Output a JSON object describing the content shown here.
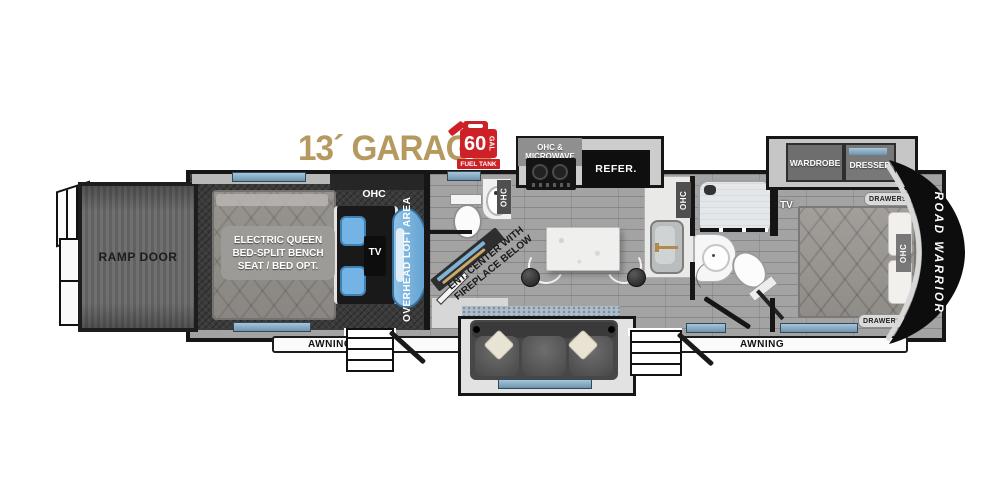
{
  "header": {
    "garage_title": "13´ GARAGE",
    "fuel_tank": {
      "value": "60",
      "unit": "GAL",
      "caption": "FUEL TANK"
    }
  },
  "exterior": {
    "ramp_door_label": "RAMP DOOR",
    "awning_left_label": "AWNING",
    "awning_right_label": "AWNING",
    "brand_label": "ROAD WARRIOR"
  },
  "garage": {
    "ohc_label": "OHC",
    "bed_label_line1": "ELECTRIC QUEEN",
    "bed_label_line2": "BED-SPLIT BENCH",
    "bed_label_line3": "SEAT / BED OPT.",
    "tv_label": "TV",
    "loft_label": "OVERHEAD LOFT AREA"
  },
  "half_bath": {
    "ohc_label": "OHC"
  },
  "living": {
    "ent_center_line1": "ENT. CENTER WITH",
    "ent_center_line2": "FIREPLACE BELOW"
  },
  "kitchen": {
    "ohc_microwave_line1": "OHC &",
    "ohc_microwave_line2": "MICROWAVE",
    "refrigerator_label": "REFER.",
    "ohc_label": "OHC"
  },
  "bedroom": {
    "wardrobe_label": "WARDROBE",
    "dresser_label": "DRESSER",
    "drawers_top_label": "DRAWERS",
    "drawers_bottom_label": "DRAWERS",
    "ohc_label": "OHC",
    "tv_label": "TV"
  },
  "colors": {
    "garage_title_gold": "#b5995f",
    "fuel_red": "#cd2027",
    "window_blue": "#7fa9c4",
    "wall_black": "#161616",
    "brand_text": "#ffffff"
  }
}
